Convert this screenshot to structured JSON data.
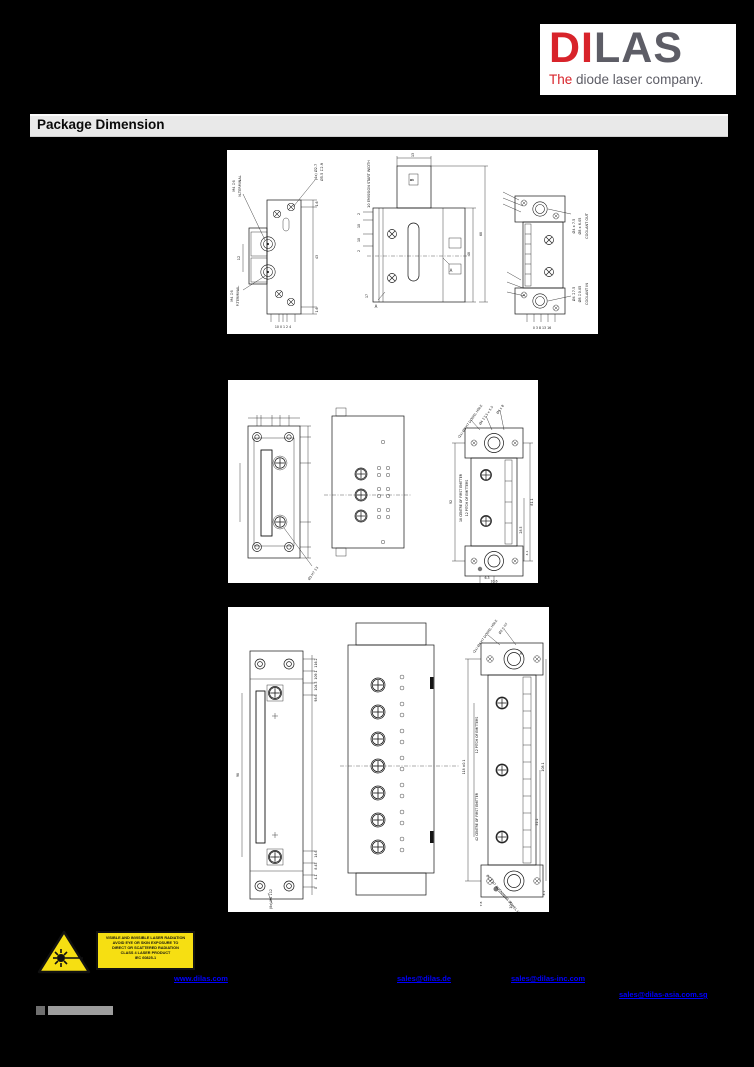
{
  "logo": {
    "part1": "DI",
    "part2": "LAS",
    "tagline_lead": "The",
    "tagline_rest": " diode laser company.",
    "red": "#d8232a",
    "gray": "#5d5d66"
  },
  "header": {
    "title": "Package Dimension"
  },
  "panel1": {
    "nterm_spec": "M4 ↧6",
    "nterm": "N-TERMINAL",
    "pterm_spec": "M4 ↧6",
    "pterm": "P-TERMINAL",
    "hole1": "(4x) Ø2.7",
    "hole2": "Ø5.5 ↧2.9",
    "emission": "10 EMISSION START WIDTH",
    "secA1": "A",
    "secA2": "A",
    "secB": "B",
    "d12": "12",
    "d16a": "1.6",
    "d43": "43",
    "d16b": "1.6",
    "d13": "13",
    "d17": "17",
    "d48": "48",
    "d68": "68",
    "d2a": "2",
    "d10a": "10",
    "d10b": "10",
    "d2b": "2",
    "ticksL": "10   0 1 2 4",
    "ticksR": "0  3  8  13  16",
    "co1": "Ø4 x 7.5",
    "co2": "Ø8 x 6.05",
    "co": "COOLANT OUT",
    "ci1": "Ø4 ↧7.5",
    "ci2": "Ø8 ↧0.05",
    "ci": "COOLANT IN"
  },
  "panel2": {
    "center_first": "18 CENTRE OF FIRST EMITTER",
    "pitch": "12 PITCH OF EMITTERS",
    "dowel": "(2x) Ø3 H7 DOWEL HOLE",
    "note2": "Ø4 ↧7.5 x 5.5",
    "note3": "Ø4 x 8",
    "note_bl": "Ø3 H7 ↧3",
    "d92": "92",
    "d811": "81.1",
    "d285": "28.5",
    "d41": "4.1",
    "d63": "6.3",
    "d106": "10.6"
  },
  "panel3": {
    "pitch": "12 PITCH OF EMITTERS",
    "center_first": "42 CENTRE OF FIRST EMITTER",
    "dowel_top": "(2x) Ø4 H7 DOWEL HOLE",
    "note_top2": "Ø2.5 H7",
    "align_note": "Ø2.5 H7 ALIGNMENT DOWEL HOLE",
    "screw_note": "(8x) M4 ↧12",
    "secA": "A",
    "d1162": "116.2",
    "d1091": "109.1",
    "d1045": "104.5",
    "d986": "98.6",
    "d146": "14.6",
    "d845": "8.45",
    "d41": "4.1",
    "d0": "0",
    "d98": "98",
    "d118": "118 ±0.1",
    "d1081": "108.1",
    "d522": "52.2",
    "d103": "10.3",
    "d78": "7.8",
    "d41b": "4.1"
  },
  "warning": {
    "lines": [
      "VISIBLE AND INVISIBLE LASER RADIATION",
      "AVOID EYE OR SKIN EXPOSURE TO",
      "DIRECT OR SCATTERED RADIATION",
      "CLASS 4 LASER PRODUCT",
      "IEC 60825-1"
    ]
  },
  "footer": {
    "links": [
      {
        "text": "www.dilas.com"
      },
      {
        "text": "sales@dilas.de"
      },
      {
        "text": "sales@dilas-inc.com"
      },
      {
        "text": "sales@dilas-asia.com.sg"
      }
    ]
  }
}
